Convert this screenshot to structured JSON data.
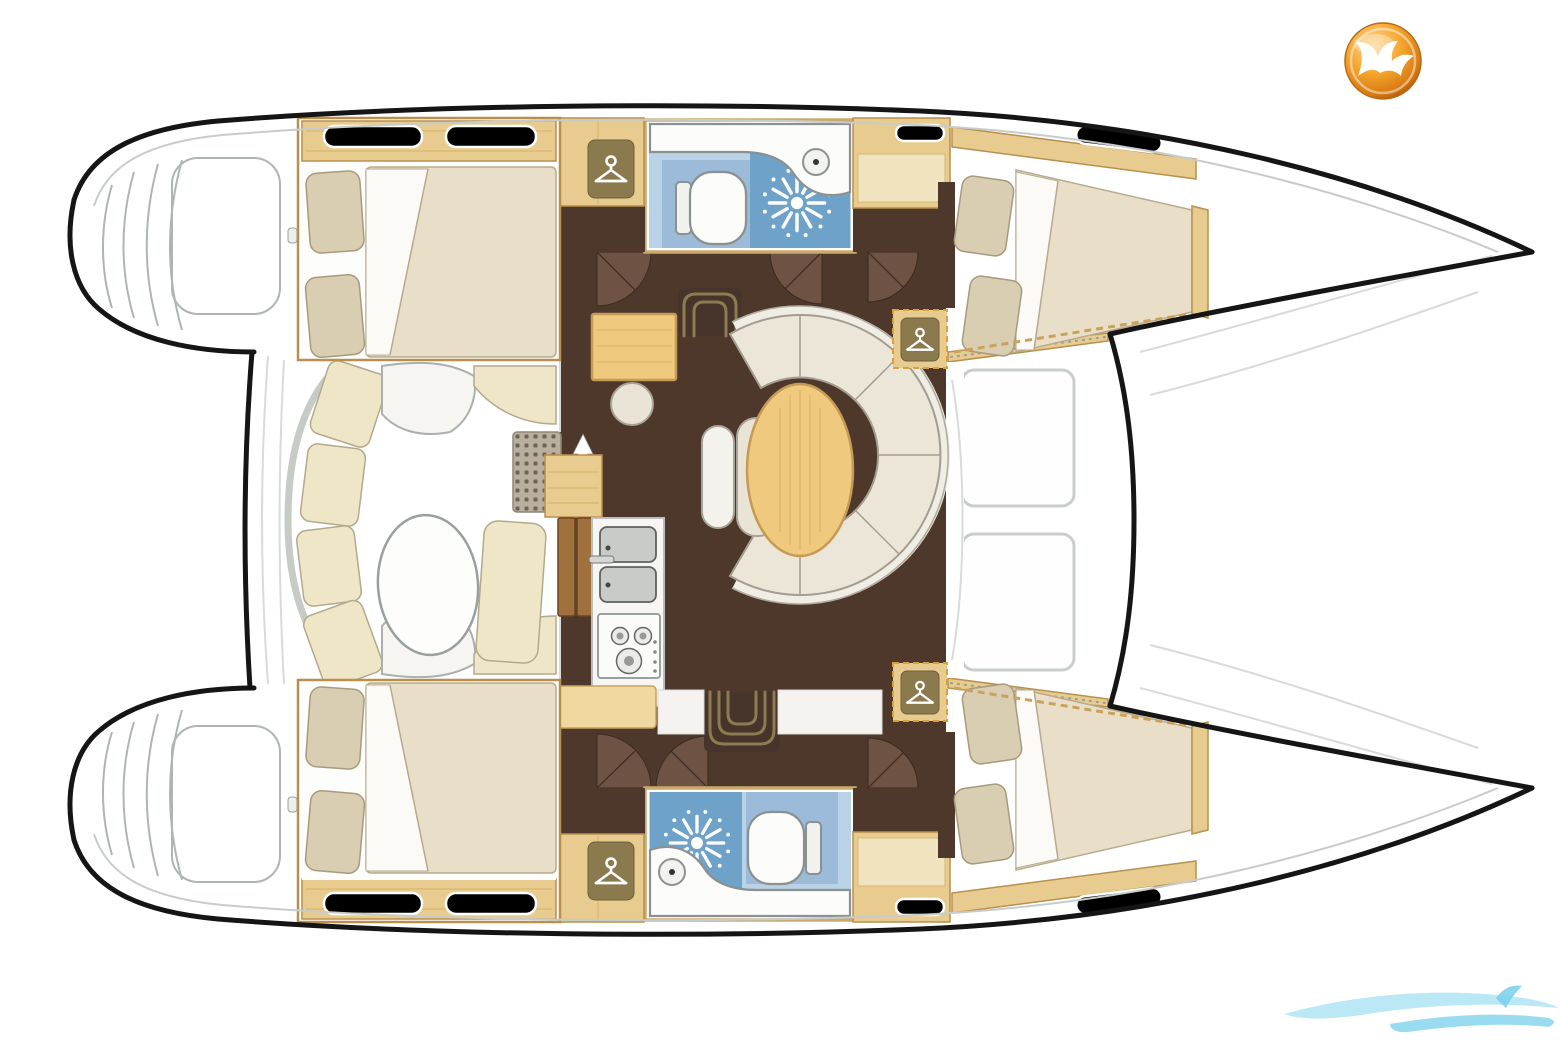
{
  "palette": {
    "hull": "#151515",
    "gunwale": "#c7cccb",
    "gray": "#aeb4b4",
    "lightgray": "#d7dbda",
    "wood": "#e8cb8e",
    "woodDark": "#c9a25d",
    "woodGrain": "#d9b76e",
    "frame": "#b98f4e",
    "door": "#a0713d",
    "doorEdge": "#6b4423",
    "wenge": "#4e382b",
    "wengeLight": "#6e5243",
    "stepOutline": "#8d7b52",
    "stepDark": "#47342a",
    "mattress": "#e9dfc8",
    "mattressEdge": "#b8ab8d",
    "pillow": "#d9cdb2",
    "pillowEdge": "#a79a7e",
    "sheet": "#fbfaf6",
    "sofa": "#ece6d9",
    "sofaEdge": "#a39d90",
    "sofaBack": "#efede4",
    "cushion": "#efe6c8",
    "cushionEdge": "#b3a98c",
    "tableWood": "#eec97e",
    "tableEdge": "#c59a54",
    "counterTan": "#f0d9a0",
    "blueFloor": "#b9d2e5",
    "blueMid": "#9cbbd8",
    "blueDeep": "#6fa2c8",
    "hatchBlue": "#cfe0ec",
    "fixture": "#fcfcfa",
    "fixtureEdge": "#8b9191",
    "steel": "#c9cbc9",
    "steelEdge": "#5f6160",
    "hanger": "#8a7a4e",
    "hangerEdge": "#6f6039",
    "dashes": "#d9a13e",
    "grid": "#b9af9f",
    "gridDot": "#6e6455",
    "gridEdge": "#8f8676",
    "offwhite": "#f4f3ef",
    "red": "#7a2020",
    "logoOrange1": "#ffd795",
    "logoOrange2": "#f5a62e",
    "logoOrange3": "#d97a12",
    "logoOrange4": "#9c4c06",
    "water1": "#aee4f2",
    "water2": "#7fd2ec"
  },
  "diagram": {
    "type": "boat-floor-plan",
    "vessel": "catamaran",
    "orientation": "bows-right"
  },
  "regions": [
    {
      "name": "port-aft-cabin",
      "feature": "double-berth"
    },
    {
      "name": "port-forward-cabin",
      "feature": "double-berth"
    },
    {
      "name": "starboard-aft-cabin",
      "feature": "double-berth"
    },
    {
      "name": "starboard-forward-cabin",
      "feature": "double-berth"
    },
    {
      "name": "port-head",
      "features": [
        "toilet",
        "shower",
        "washbasin"
      ]
    },
    {
      "name": "starboard-head",
      "features": [
        "toilet",
        "shower",
        "washbasin"
      ]
    },
    {
      "name": "salon-dinette",
      "features": [
        "curved-sofa",
        "oval-table",
        "bench"
      ]
    },
    {
      "name": "galley",
      "features": [
        "double-sink",
        "stove",
        "cabinets"
      ]
    },
    {
      "name": "nav-station",
      "features": [
        "chart-desk",
        "stool"
      ]
    },
    {
      "name": "aft-cockpit",
      "features": [
        "curved-bench",
        "oval-table",
        "lounge-seat"
      ]
    },
    {
      "name": "foredeck-trampoline",
      "features": [
        "net-panel",
        "net-panel"
      ]
    },
    {
      "name": "port-stern-platform",
      "feature": "transom-steps"
    },
    {
      "name": "starboard-stern-platform",
      "feature": "transom-steps"
    }
  ],
  "icons": [
    "hanger-icon",
    "shower-starburst-icon",
    "stairs-up-arrow-icon",
    "stairs-down-arrow-icon",
    "companionway-steps-icon",
    "gull-logo-icon",
    "wave-watermark-icon"
  ]
}
